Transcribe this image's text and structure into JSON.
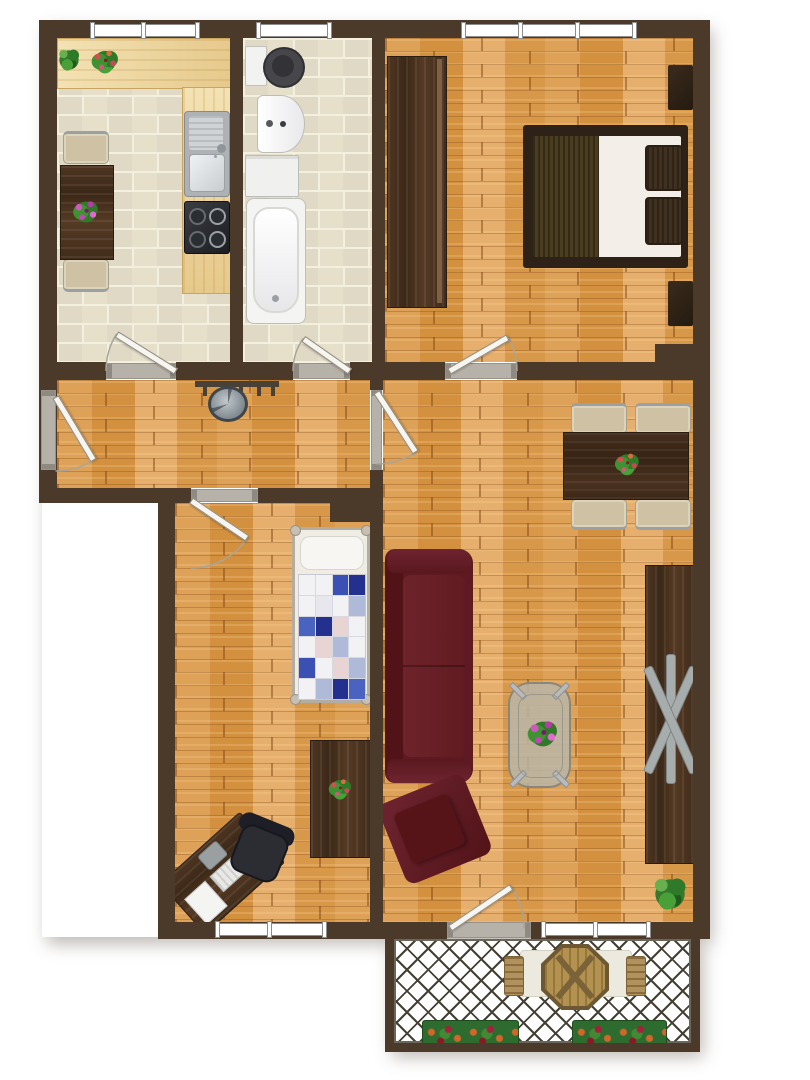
{
  "plan": {
    "type": "apartment-floor-plan-top-view",
    "visible_text": "",
    "openings": {
      "windows": 5,
      "interior_doors": 6,
      "entrance_doors": 1
    }
  },
  "palette": {
    "background": "#ffffff",
    "wall": "#4b3a2a",
    "wood_floor": "#dc9e54",
    "tile_floor": "#e6e0cb",
    "tile_grout": "#f4f0e0",
    "counter": "#ecd49c",
    "dark_wood": "#46301f",
    "sofa_red": "#5e1a20",
    "bed_blanket": "#4a3d20",
    "window_white": "#ffffff",
    "frame_gray": "#8d8d8d",
    "threshold_gray": "#b7b2a9",
    "door_leaf": "#f7f5f0",
    "lattice_line": "#454034",
    "plant_green": "#3a8a32",
    "metal_gray": "#a7adad"
  },
  "rooms": [
    {
      "id": "kitchen",
      "name": "Kitchen",
      "floor": "beige tiles",
      "furniture": [
        "worktop counter",
        "sink",
        "stove",
        "table",
        "2 chairs",
        "2 plants"
      ]
    },
    {
      "id": "bathroom",
      "name": "Bathroom",
      "floor": "beige tiles",
      "furniture": [
        "toilet",
        "wash basin",
        "washing machine",
        "bathtub"
      ]
    },
    {
      "id": "bedroom",
      "name": "Bedroom",
      "floor": "wood parquet",
      "furniture": [
        "wardrobe",
        "double bed",
        "2 nightstands"
      ]
    },
    {
      "id": "hallway",
      "name": "Hallway",
      "floor": "wood parquet",
      "furniture": [
        "coat rack",
        "ceiling lamp"
      ]
    },
    {
      "id": "kids-room",
      "name": "Children's room",
      "floor": "wood parquet",
      "furniture": [
        "single bed",
        "chest of drawers",
        "desk",
        "office chair"
      ]
    },
    {
      "id": "living-room",
      "name": "Living room",
      "floor": "wood parquet",
      "furniture": [
        "dining table",
        "4 chairs",
        "sofa",
        "armchair",
        "coffee table",
        "tall cabinet",
        "plant"
      ]
    },
    {
      "id": "balcony",
      "name": "Balcony",
      "floor": "lattice deck",
      "furniture": [
        "octagonal table",
        "2 slat chairs",
        "2 flower boxes"
      ]
    }
  ]
}
